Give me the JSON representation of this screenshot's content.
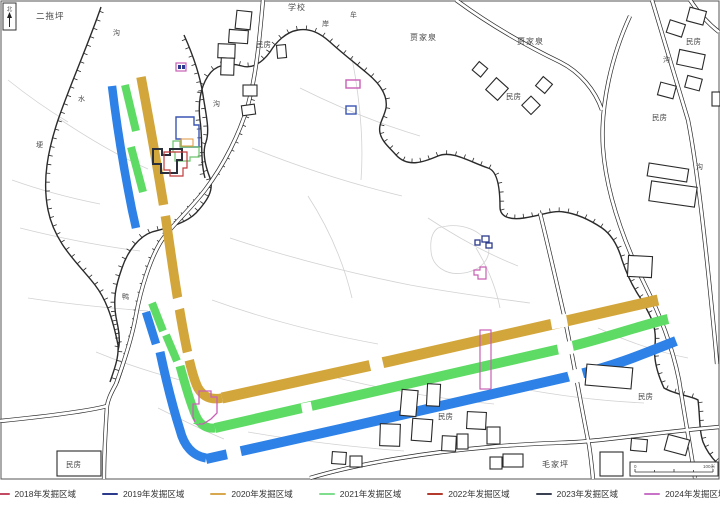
{
  "map": {
    "north_label": "北",
    "scale_bar": {
      "start": "0",
      "end": "100米"
    },
    "bands": {
      "gold": "#D3A63B",
      "green": "#5EDB64",
      "blue": "#2E81E6"
    },
    "marks": {
      "cluster_blue": "#3A55B4",
      "cluster_green": "#6CC46C",
      "cluster_orange": "#E2953F",
      "cluster_black": "#2A2F3A",
      "cluster_red": "#C23B3B",
      "magenta": "#C95FB5",
      "navy_blue": "#2B3A8C"
    },
    "labels": [
      {
        "text": "二拖坪"
      },
      {
        "text": "学校"
      },
      {
        "text": "牟"
      },
      {
        "text": "岸"
      },
      {
        "text": "贾家泉"
      },
      {
        "text": "贾家泉"
      },
      {
        "text": "民房"
      },
      {
        "text": "民房"
      },
      {
        "text": "民房"
      },
      {
        "text": "民房"
      },
      {
        "text": "沟"
      },
      {
        "text": "水"
      },
      {
        "text": "埂"
      },
      {
        "text": "沟"
      },
      {
        "text": "沟"
      },
      {
        "text": "沟"
      },
      {
        "text": "鸭"
      },
      {
        "text": "民房"
      },
      {
        "text": "民房"
      },
      {
        "text": "毛家坪"
      },
      {
        "text": "民房"
      }
    ]
  },
  "legend": {
    "items": [
      {
        "label": "2018年发掘区域",
        "color": "#C24A63"
      },
      {
        "label": "2019年发掘区域",
        "color": "#2B3A8C"
      },
      {
        "label": "2020年发掘区域",
        "color": "#D7A84E"
      },
      {
        "label": "2021年发掘区域",
        "color": "#7FDD8E"
      },
      {
        "label": "2022年发掘区域",
        "color": "#B23B2E"
      },
      {
        "label": "2023年发掘区域",
        "color": "#3A4152"
      },
      {
        "label": "2024年发掘区域",
        "color": "#C873C8"
      }
    ]
  }
}
